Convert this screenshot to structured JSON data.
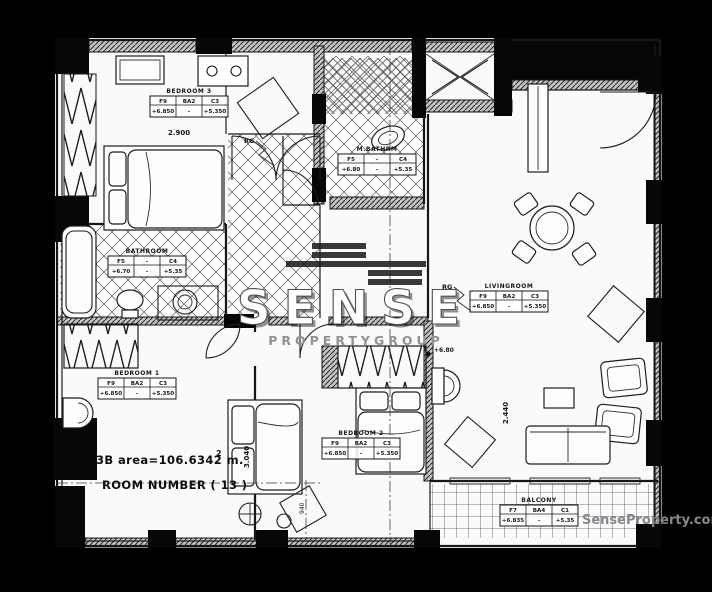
{
  "image": {
    "type": "apartment floor plan",
    "area_text": "3B area=106.6342 m.",
    "area_superscript": "2",
    "room_number_text": "ROOM NUMBER ( 13 )"
  },
  "plan": {
    "rooms": [
      {
        "name": "BEDROOM 3",
        "cols": [
          "F9",
          "BA2",
          "C3"
        ],
        "vals": [
          "+6.850",
          "-",
          "+5.350"
        ]
      },
      {
        "name": "BATHROOM",
        "cols": [
          "F5",
          "-",
          "C4"
        ],
        "vals": [
          "+6.70",
          "-",
          "+5.35"
        ]
      },
      {
        "name": "M.BATHRM",
        "cols": [
          "F5",
          "-",
          "C4"
        ],
        "vals": [
          "+6.80",
          "-",
          "+5.35"
        ]
      },
      {
        "name": "BEDROOM 1",
        "cols": [
          "F9",
          "BA2",
          "C3"
        ],
        "vals": [
          "+6.850",
          "-",
          "+5.350"
        ]
      },
      {
        "name": "BEDROOM 2",
        "cols": [
          "F9",
          "BA2",
          "C3"
        ],
        "vals": [
          "+6.850",
          "-",
          "+5.350"
        ]
      },
      {
        "name": "LIVINGROOM",
        "cols": [
          "F9",
          "BA2",
          "C3"
        ],
        "vals": [
          "+6.850",
          "-",
          "+5.350"
        ]
      },
      {
        "name": "BALCONY",
        "cols": [
          "F7",
          "BA4",
          "C1"
        ],
        "vals": [
          "+6.835",
          "-",
          "+5.35"
        ]
      }
    ],
    "dimensions": {
      "d1": "2.900",
      "d2": "3.040",
      "d3": "2.440",
      "d4": "940"
    },
    "markers": {
      "rg1": "RG",
      "rg2": "RG",
      "level1": "+6.80"
    }
  },
  "watermark": {
    "brand": "SENSE",
    "tagline": "PROPERTYGROUP",
    "website": "SenseProperty.com"
  },
  "colors": {
    "background": "#000000",
    "paper": "#fafafa",
    "ink": "#161616",
    "watermark_brand": "#ffffff",
    "watermark_gray": "#8d9298",
    "website_gray": "#85898f"
  }
}
